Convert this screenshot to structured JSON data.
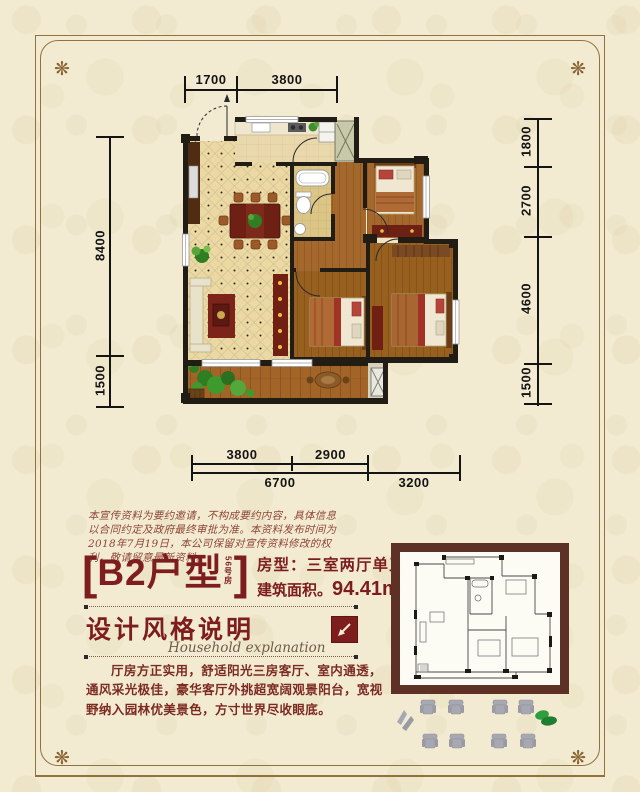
{
  "colors": {
    "background": "#f2ebd2",
    "frame": "#93713d",
    "accent_red": "#7d1d1d",
    "body_red": "#7c2a22",
    "wall": "#211c14"
  },
  "icons": {
    "corner_ornament": "❋",
    "arrow_box_icon": "diagonal-arrow-down-left",
    "decor_icons": [
      "chair-top-view",
      "swoosh",
      "plant"
    ]
  },
  "plan": {
    "dims": {
      "top": [
        "1700",
        "3800"
      ],
      "left": [
        "8400",
        "1500"
      ],
      "right": [
        "1800",
        "2700",
        "4600",
        "1500"
      ],
      "bottom_inner": [
        "3800",
        "2900"
      ],
      "bottom_outer": [
        "6700",
        "3200"
      ]
    }
  },
  "disclaimer": "本宣传资料为要约邀请，不构成要约内容，具体信息以合同约定及政府最终审批为准。本资料发布时间为2018年7月19日，本公司保留对宣传资料修改的权利，敬请留意最新资料。",
  "unit": {
    "bracket_open": "[",
    "name": "B2户型",
    "sub_label": "56号房",
    "bracket_close": "]",
    "room_type": "房型：三室两厅单卫",
    "area_prefix": "建筑面积。",
    "area_value": "94.41m",
    "area_sup": "2"
  },
  "design": {
    "heading": "设计风格说明",
    "heading_en": "Household explanation",
    "body": "厅房方正实用，舒适阳光三房客厅、室内通透，通风采光极佳，豪华客厅外挑超宽阔观景阳台，宽视野纳入园林优美景色，方寸世界尽收眼底。"
  }
}
